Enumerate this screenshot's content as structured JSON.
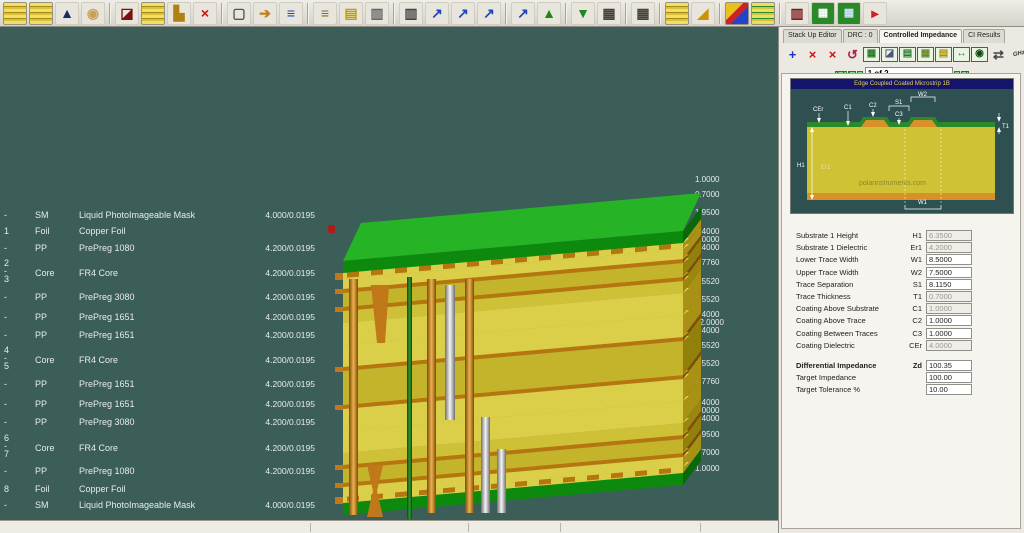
{
  "toolbar": {
    "icons": [
      {
        "name": "new-stackup-icon",
        "cls": "stack"
      },
      {
        "name": "open-stackup-icon",
        "cls": "stack"
      },
      {
        "name": "stackup-wizard-icon",
        "glyph": "▲",
        "color": "#1b2a6b"
      },
      {
        "name": "bell-icon",
        "glyph": "◉",
        "color": "#c8a05a"
      },
      {
        "name": "mirror-stackup-icon",
        "glyph": "◪",
        "color": "#7a1010",
        "sep": true
      },
      {
        "name": "add-layer-icon",
        "cls": "stack"
      },
      {
        "name": "add-drill-icon",
        "glyph": "▙",
        "color": "#b08010"
      },
      {
        "name": "delete-icon",
        "glyph": "×",
        "color": "#cc1111"
      },
      {
        "name": "frame-icon",
        "glyph": "▢",
        "color": "#555",
        "sep": true
      },
      {
        "name": "move-layer-icon",
        "glyph": "➔",
        "color": "#c08020"
      },
      {
        "name": "swap-layers-icon",
        "glyph": "≡",
        "color": "#2244aa"
      },
      {
        "name": "reorder-layers-icon",
        "glyph": "≡",
        "color": "#8a6a20",
        "sep": true
      },
      {
        "name": "notes-icon",
        "glyph": "▤",
        "color": "#c0a000"
      },
      {
        "name": "print-icon",
        "glyph": "▥",
        "color": "#666"
      },
      {
        "name": "print-report-icon",
        "glyph": "▥",
        "color": "#444",
        "sep": true
      },
      {
        "name": "drill-tool-1-icon",
        "glyph": "↗",
        "color": "#2244bb"
      },
      {
        "name": "drill-tool-2-icon",
        "glyph": "↗",
        "color": "#2244bb"
      },
      {
        "name": "drill-tool-3-icon",
        "glyph": "↗",
        "color": "#2244bb"
      },
      {
        "name": "drill-tool-4-icon",
        "glyph": "↗",
        "color": "#2244bb",
        "sep": true
      },
      {
        "name": "import-icon",
        "glyph": "▲",
        "color": "#1a8a1a"
      },
      {
        "name": "export-icon",
        "glyph": "▼",
        "color": "#1a8a1a",
        "sep": true
      },
      {
        "name": "drill-machine-1-icon",
        "glyph": "▦",
        "color": "#44403a"
      },
      {
        "name": "drill-machine-2-icon",
        "glyph": "▦",
        "color": "#44403a",
        "sep": true
      },
      {
        "name": "thick-stack-icon",
        "cls": "stack",
        "sep": true
      },
      {
        "name": "eraser-3d-icon",
        "glyph": "◢",
        "color": "#d09000"
      },
      {
        "name": "material-cube-icon",
        "cls": "cube",
        "sep": true
      },
      {
        "name": "stack-materials-icon",
        "cls": "stackg"
      },
      {
        "name": "column-chart-icon",
        "glyph": "▥",
        "color": "#7a1a1a",
        "sep": true
      },
      {
        "name": "calc-impedance-icon",
        "cls": "calc",
        "glyph": "▦",
        "color": "#ffffff"
      },
      {
        "name": "calc-field-icon",
        "cls": "calc",
        "glyph": "▦",
        "color": "#cfe0ff"
      },
      {
        "name": "pin-icon",
        "glyph": "▸",
        "color": "#cc2222"
      }
    ]
  },
  "stackup": {
    "rows": [
      {
        "num": "-",
        "type": "SM",
        "material": "Liquid PhotoImageable Mask",
        "value": "4.000/0.0195"
      },
      {
        "num": "1",
        "type": "Foil",
        "material": "Copper Foil",
        "value": ""
      },
      {
        "num": "-",
        "type": "PP",
        "material": "PrePreg 1080",
        "value": "4.200/0.0195"
      },
      {
        "num": "2",
        "num2": "3",
        "type": "Core",
        "material": "FR4 Core",
        "value": "4.200/0.0195"
      },
      {
        "num": "-",
        "type": "PP",
        "material": "PrePreg 3080",
        "value": "4.200/0.0195"
      },
      {
        "num": "-",
        "type": "PP",
        "material": "PrePreg 1651",
        "value": "4.200/0.0195"
      },
      {
        "num": "-",
        "type": "PP",
        "material": "PrePreg 1651",
        "value": "4.200/0.0195"
      },
      {
        "num": "4",
        "num2": "5",
        "type": "Core",
        "material": "FR4 Core",
        "value": "4.200/0.0195"
      },
      {
        "num": "-",
        "type": "PP",
        "material": "PrePreg 1651",
        "value": "4.200/0.0195"
      },
      {
        "num": "-",
        "type": "PP",
        "material": "PrePreg 1651",
        "value": "4.200/0.0195"
      },
      {
        "num": "-",
        "type": "PP",
        "material": "PrePreg 3080",
        "value": "4.200/0.0195"
      },
      {
        "num": "6",
        "num2": "7",
        "type": "Core",
        "material": "FR4 Core",
        "value": "4.200/0.0195"
      },
      {
        "num": "-",
        "type": "PP",
        "material": "PrePreg 1080",
        "value": "4.200/0.0195"
      },
      {
        "num": "8",
        "type": "Foil",
        "material": "Copper Foil",
        "value": ""
      },
      {
        "num": "-",
        "type": "SM",
        "material": "Liquid PhotoImageable Mask",
        "value": "4.000/0.0195"
      }
    ],
    "thickness_labels": [
      "1.0000",
      "0.7000",
      "1.9500",
      "1.4000",
      "3.0000",
      "1.4000",
      "2.7760",
      "5.5520",
      "5.5520",
      "1.4000",
      "12.0000",
      "1.4000",
      "5.5520",
      "5.5520",
      "2.7760",
      "1.4000",
      "3.0000",
      "1.4000",
      "1.9500",
      "0.7000",
      "1.0000"
    ]
  },
  "panel": {
    "tabs": [
      {
        "label": "Stack Up Editor"
      },
      {
        "label": "DRC : 0"
      },
      {
        "label": "Controlled Impedance"
      },
      {
        "label": "CI Results"
      }
    ],
    "icons": [
      {
        "name": "add-structure-icon",
        "glyph": "+",
        "color": "#1133cc"
      },
      {
        "name": "delete-structure-icon",
        "glyph": "×",
        "color": "#cc1111"
      },
      {
        "name": "delete-all-structures-icon",
        "glyph": "×",
        "color": "#cc1111"
      },
      {
        "name": "refresh-structure-icon",
        "glyph": "↺",
        "color": "#aa2244"
      },
      {
        "name": "calc-structure-icon",
        "glyph": "▦",
        "color": "#2a7a2a",
        "box": true
      },
      {
        "name": "structure-image-icon",
        "glyph": "◪",
        "color": "#557",
        "box": true
      },
      {
        "name": "structure-layers-icon",
        "glyph": "▤",
        "color": "#2a7a2a",
        "box": true
      },
      {
        "name": "trace-style-icon",
        "glyph": "▦",
        "color": "#6a8a2a",
        "box": true
      },
      {
        "name": "coating-icon",
        "glyph": "▤",
        "color": "#b09000",
        "box": true
      },
      {
        "name": "measure-icon",
        "glyph": "↔",
        "color": "#2a7a2a",
        "box": true
      },
      {
        "name": "view-structure-icon",
        "glyph": "◉",
        "color": "#0a4a0a",
        "box": true
      },
      {
        "name": "pair-icon",
        "glyph": "⇄",
        "color": "#444"
      },
      {
        "name": "ghz-icon",
        "text": "GHz"
      }
    ],
    "nav": {
      "prev_buttons": [
        "1:1",
        "|<",
        "<"
      ],
      "position": "1 of 2",
      "next_buttons": [
        ">",
        ">|"
      ]
    },
    "structure": {
      "title": "Edge Coupled Coated Microstrip 1B",
      "watermark": "polarinstruments.com",
      "labels": {
        "cer": "CEr",
        "c1": "C1",
        "c2": "C2",
        "s1": "S1",
        "c3": "C3",
        "w2": "W2",
        "t1": "T1",
        "h1": "H1",
        "er1": "Er1",
        "w1": "W1"
      }
    },
    "params": [
      {
        "label": "Substrate 1 Height",
        "code": "H1",
        "value": "6.3500",
        "editable": false
      },
      {
        "label": "Substrate 1 Dielectric",
        "code": "Er1",
        "value": "4.2000",
        "editable": false
      },
      {
        "label": "Lower Trace Width",
        "code": "W1",
        "value": "8.5000",
        "editable": true
      },
      {
        "label": "Upper Trace Width",
        "code": "W2",
        "value": "7.5000",
        "editable": true
      },
      {
        "label": "Trace Separation",
        "code": "S1",
        "value": "8.1150",
        "editable": true
      },
      {
        "label": "Trace Thickness",
        "code": "T1",
        "value": "0.7000",
        "editable": false
      },
      {
        "label": "Coating Above Substrate",
        "code": "C1",
        "value": "1.0000",
        "editable": false
      },
      {
        "label": "Coating Above Trace",
        "code": "C2",
        "value": "1.0000",
        "editable": true
      },
      {
        "label": "Coating Between Traces",
        "code": "C3",
        "value": "1.0000",
        "editable": true
      },
      {
        "label": "Coating Dielectric",
        "code": "CEr",
        "value": "4.0000",
        "editable": false
      }
    ],
    "impedance": {
      "diff_label": "Differential Impedance",
      "diff_code": "Zd",
      "diff_value": "100.35",
      "target_label": "Target Impedance",
      "target_value": "100.00",
      "tol_label": "Target Tolerance %",
      "tol_value": "10.00"
    }
  }
}
